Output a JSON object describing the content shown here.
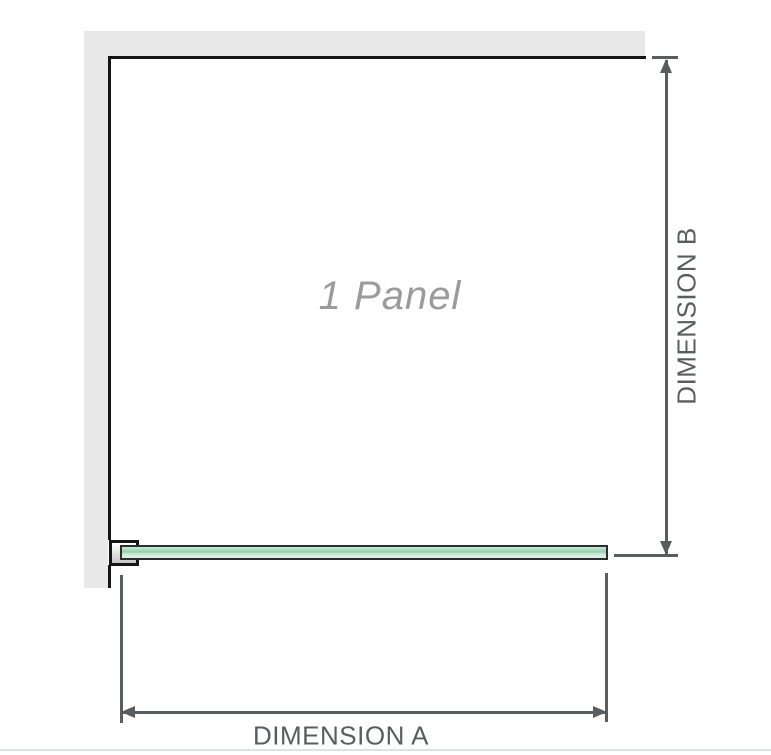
{
  "diagram": {
    "panel": {
      "label": "1 Panel"
    },
    "dimension_a": {
      "label": "DIMENSION A"
    },
    "dimension_b": {
      "label": "DIMENSION B"
    }
  },
  "colors": {
    "background": "#ffffff",
    "wall-fill": "#e8e8e8",
    "wall-edge": "#151515",
    "glass-outline": "#2d2d2d",
    "glass-green-light": "#c9e9d6",
    "glass-green-mid": "#96cfac",
    "glass-green-pale": "#e2f4e9",
    "bracket-fill-top": "#ffffff",
    "bracket-fill-bottom": "#c6c6c6",
    "dimension-line": "#5a5d60",
    "panel-label-gray": "#9b9b9b",
    "divider": "#dce2e7"
  }
}
